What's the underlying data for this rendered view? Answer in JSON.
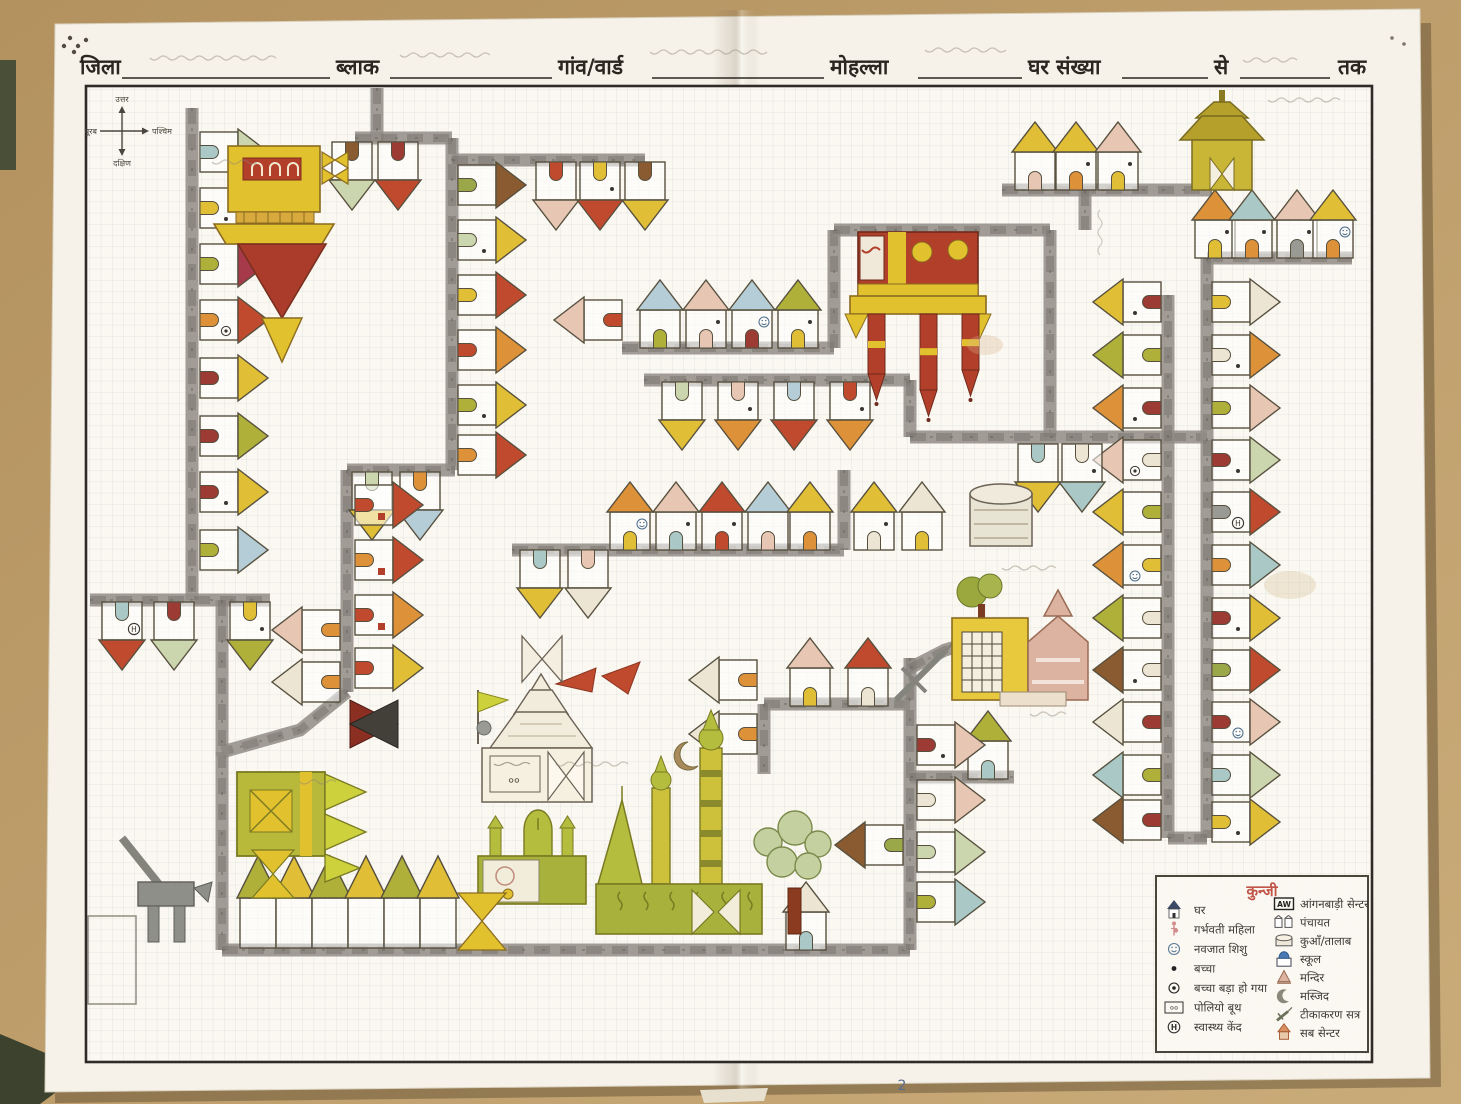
{
  "photo": {
    "desk_color": "#b3925f",
    "desk_color_light": "#c9ab79",
    "paper_color": "#f6f2e9"
  },
  "header": {
    "fields": [
      "जिला",
      "ब्लाक",
      "गांव/वार्ड",
      "मोहल्ला",
      "घर संख्या",
      "से",
      "तक"
    ]
  },
  "compass": {
    "north": "उत्तर",
    "south": "दक्षिण",
    "east": "पूरब",
    "west": "पश्चिम"
  },
  "legend": {
    "title": "कुन्जी",
    "left": [
      {
        "icon": "house-icon",
        "label": "घर"
      },
      {
        "icon": "pregnant-woman-icon",
        "label": "गर्भवती महिला"
      },
      {
        "icon": "newborn-icon",
        "label": "नवजात शिशु"
      },
      {
        "icon": "child-icon",
        "label": "बच्चा"
      },
      {
        "icon": "child-grown-icon",
        "label": "बच्चा बड़ा हो गया"
      },
      {
        "icon": "polio-booth-icon",
        "label": "पोलियो बूथ"
      },
      {
        "icon": "health-centre-icon",
        "label": "स्वास्थ्य केंद"
      }
    ],
    "right": [
      {
        "icon": "anganwadi-icon",
        "label": "आंगनबाड़ी सेन्टर",
        "badge": "AW"
      },
      {
        "icon": "panchayat-icon",
        "label": "पंचायत"
      },
      {
        "icon": "well-pond-icon",
        "label": "कुआँ/तालाब"
      },
      {
        "icon": "school-icon",
        "label": "स्कूल"
      },
      {
        "icon": "temple-icon",
        "label": "मन्दिर"
      },
      {
        "icon": "mosque-icon",
        "label": "मस्जिद"
      },
      {
        "icon": "vaccination-icon",
        "label": "टीकाकरण सत्र"
      },
      {
        "icon": "subcentre-icon",
        "label": "सब सेन्टर"
      }
    ],
    "polio_booth_glyph": "००",
    "health_glyph": "H"
  },
  "page_mark": "2",
  "map_data": {
    "type": "hand-drawn-village-map",
    "palette": {
      "yellow": "#e0bf36",
      "olive": "#aeb03a",
      "red": "#c04a2e",
      "darkred": "#9c3b33",
      "maroon": "#a63a4a",
      "orange": "#dd9138",
      "pink": "#e7c6b4",
      "lightgreen": "#ccd6ae",
      "teal": "#a9c8c6",
      "lightblue": "#b5cdd6",
      "brown": "#8a5a30",
      "pale": "#ece5d4",
      "green": "#9aa84a",
      "gray": "#9a9a94",
      "road": "#908c85",
      "roaddark": "#6f6a63"
    },
    "roads": [
      [
        [
          377,
          88
        ],
        [
          377,
          142
        ]
      ],
      [
        [
          355,
          138
        ],
        [
          452,
          138
        ]
      ],
      [
        [
          452,
          138
        ],
        [
          452,
          470
        ]
      ],
      [
        [
          452,
          160
        ],
        [
          645,
          160
        ]
      ],
      [
        [
          347,
          470
        ],
        [
          455,
          470
        ]
      ],
      [
        [
          347,
          470
        ],
        [
          347,
          692
        ]
      ],
      [
        [
          347,
          692
        ],
        [
          300,
          730
        ],
        [
          222,
          752
        ]
      ],
      [
        [
          222,
          752
        ],
        [
          222,
          950
        ]
      ],
      [
        [
          222,
          950
        ],
        [
          910,
          950
        ]
      ],
      [
        [
          192,
          108
        ],
        [
          192,
          600
        ]
      ],
      [
        [
          90,
          600
        ],
        [
          270,
          600
        ]
      ],
      [
        [
          222,
          600
        ],
        [
          222,
          756
        ]
      ],
      [
        [
          622,
          348
        ],
        [
          834,
          348
        ]
      ],
      [
        [
          834,
          230
        ],
        [
          834,
          348
        ]
      ],
      [
        [
          834,
          230
        ],
        [
          1050,
          230
        ]
      ],
      [
        [
          1050,
          230
        ],
        [
          1050,
          437
        ]
      ],
      [
        [
          644,
          380
        ],
        [
          910,
          380
        ]
      ],
      [
        [
          910,
          380
        ],
        [
          910,
          437
        ]
      ],
      [
        [
          910,
          437
        ],
        [
          1207,
          437
        ]
      ],
      [
        [
          512,
          550
        ],
        [
          844,
          550
        ]
      ],
      [
        [
          844,
          470
        ],
        [
          844,
          550
        ]
      ],
      [
        [
          1002,
          190
        ],
        [
          1212,
          190
        ]
      ],
      [
        [
          1085,
          190
        ],
        [
          1085,
          230
        ]
      ],
      [
        [
          1207,
          258
        ],
        [
          1352,
          258
        ]
      ],
      [
        [
          1207,
          258
        ],
        [
          1207,
          838
        ]
      ],
      [
        [
          1168,
          295
        ],
        [
          1168,
          838
        ]
      ],
      [
        [
          1168,
          838
        ],
        [
          1207,
          838
        ]
      ],
      [
        [
          764,
          704
        ],
        [
          910,
          704
        ]
      ],
      [
        [
          764,
          704
        ],
        [
          764,
          774
        ]
      ],
      [
        [
          910,
          658
        ],
        [
          910,
          950
        ]
      ],
      [
        [
          910,
          777
        ],
        [
          1014,
          777
        ]
      ],
      [
        [
          910,
          668
        ],
        [
          945,
          650
        ],
        [
          972,
          642
        ]
      ]
    ],
    "houses": [
      [
        200,
        152,
        "R",
        "lightgreen",
        "teal",
        ""
      ],
      [
        200,
        208,
        "R",
        "pink",
        "yellow",
        "dot"
      ],
      [
        200,
        264,
        "R",
        "maroon",
        "olive",
        ""
      ],
      [
        200,
        320,
        "R",
        "red",
        "orange",
        "circledot"
      ],
      [
        200,
        378,
        "R",
        "yellow",
        "darkred",
        ""
      ],
      [
        200,
        436,
        "R",
        "olive",
        "darkred",
        ""
      ],
      [
        200,
        492,
        "R",
        "yellow",
        "darkred",
        "dot"
      ],
      [
        200,
        550,
        "R",
        "lightblue",
        "olive",
        ""
      ],
      [
        458,
        185,
        "R",
        "brown",
        "green",
        ""
      ],
      [
        458,
        240,
        "R",
        "yellow",
        "lightgreen",
        "dot"
      ],
      [
        458,
        295,
        "R",
        "red",
        "yellow",
        ""
      ],
      [
        458,
        350,
        "R",
        "orange",
        "red",
        ""
      ],
      [
        458,
        405,
        "R",
        "yellow",
        "olive",
        "dot"
      ],
      [
        458,
        455,
        "R",
        "red",
        "orange",
        ""
      ],
      [
        352,
        142,
        "D",
        "lightgreen",
        "brown",
        ""
      ],
      [
        398,
        142,
        "D",
        "red",
        "darkred",
        ""
      ],
      [
        556,
        162,
        "D",
        "pink",
        "red",
        ""
      ],
      [
        600,
        162,
        "D",
        "red",
        "yellow",
        "dot"
      ],
      [
        645,
        162,
        "D",
        "yellow",
        "brown",
        ""
      ],
      [
        660,
        348,
        "U",
        "lightblue",
        "olive",
        ""
      ],
      [
        706,
        348,
        "U",
        "pink",
        "pink",
        "dot"
      ],
      [
        752,
        348,
        "U",
        "lightblue",
        "darkred",
        "smiley"
      ],
      [
        798,
        348,
        "U",
        "olive",
        "yellow",
        "dot"
      ],
      [
        622,
        320,
        "L",
        "pink",
        "red",
        ""
      ],
      [
        682,
        382,
        "D",
        "yellow",
        "lightgreen",
        ""
      ],
      [
        738,
        382,
        "D",
        "orange",
        "pink",
        "dot"
      ],
      [
        794,
        382,
        "D",
        "red",
        "lightblue",
        ""
      ],
      [
        850,
        382,
        "D",
        "orange",
        "red",
        "dot"
      ],
      [
        630,
        550,
        "U",
        "orange",
        "yellow",
        "smiley"
      ],
      [
        676,
        550,
        "U",
        "pink",
        "teal",
        "dot"
      ],
      [
        722,
        550,
        "U",
        "red",
        "red",
        "dot"
      ],
      [
        768,
        550,
        "U",
        "lightblue",
        "pink",
        ""
      ],
      [
        810,
        550,
        "U",
        "yellow",
        "orange",
        ""
      ],
      [
        874,
        550,
        "U",
        "yellow",
        "pale",
        "dot"
      ],
      [
        922,
        550,
        "U",
        "pale",
        "yellow",
        ""
      ],
      [
        540,
        550,
        "D",
        "yellow",
        "teal",
        ""
      ],
      [
        588,
        550,
        "D",
        "pale",
        "pink",
        ""
      ],
      [
        372,
        472,
        "D",
        "yellow",
        "lightgreen",
        ""
      ],
      [
        420,
        472,
        "D",
        "lightblue",
        "orange",
        ""
      ],
      [
        355,
        505,
        "R",
        "red",
        "red",
        "win"
      ],
      [
        355,
        560,
        "R",
        "red",
        "orange",
        "win"
      ],
      [
        355,
        615,
        "R",
        "orange",
        "red",
        "win"
      ],
      [
        355,
        668,
        "R",
        "yellow",
        "red",
        ""
      ],
      [
        340,
        630,
        "L",
        "pink",
        "orange",
        ""
      ],
      [
        340,
        682,
        "L",
        "pale",
        "orange",
        ""
      ],
      [
        122,
        602,
        "D",
        "red",
        "teal",
        "H"
      ],
      [
        174,
        602,
        "D",
        "lightgreen",
        "darkred",
        ""
      ],
      [
        250,
        602,
        "D",
        "olive",
        "yellow",
        "dot"
      ],
      [
        757,
        680,
        "L",
        "pale",
        "orange",
        ""
      ],
      [
        757,
        734,
        "L",
        "pale",
        "orange",
        ""
      ],
      [
        810,
        706,
        "U",
        "pink",
        "yellow",
        ""
      ],
      [
        868,
        706,
        "U",
        "red",
        "pale",
        ""
      ],
      [
        988,
        779,
        "U",
        "olive",
        "teal",
        ""
      ],
      [
        903,
        845,
        "L",
        "brown",
        "green",
        ""
      ],
      [
        917,
        745,
        "R",
        "pink",
        "darkred",
        "dot"
      ],
      [
        917,
        800,
        "R",
        "pink",
        "pale",
        ""
      ],
      [
        917,
        852,
        "R",
        "lightgreen",
        "lightgreen",
        ""
      ],
      [
        917,
        902,
        "R",
        "teal",
        "olive",
        ""
      ],
      [
        806,
        950,
        "U",
        "pale",
        "teal",
        ""
      ],
      [
        1161,
        302,
        "L",
        "yellow",
        "darkred",
        "dot"
      ],
      [
        1161,
        355,
        "L",
        "olive",
        "olive",
        ""
      ],
      [
        1161,
        408,
        "L",
        "orange",
        "darkred",
        "dot"
      ],
      [
        1161,
        460,
        "L",
        "pink",
        "pale",
        "circledot"
      ],
      [
        1161,
        512,
        "L",
        "yellow",
        "olive",
        ""
      ],
      [
        1161,
        565,
        "L",
        "orange",
        "yellow",
        "smiley"
      ],
      [
        1161,
        618,
        "L",
        "olive",
        "pale",
        ""
      ],
      [
        1161,
        670,
        "L",
        "brown",
        "pale",
        "dot"
      ],
      [
        1161,
        722,
        "L",
        "pale",
        "darkred",
        ""
      ],
      [
        1161,
        775,
        "L",
        "teal",
        "olive",
        ""
      ],
      [
        1161,
        820,
        "L",
        "brown",
        "darkred",
        ""
      ],
      [
        1212,
        302,
        "R",
        "pale",
        "yellow",
        ""
      ],
      [
        1212,
        355,
        "R",
        "orange",
        "pale",
        "dot"
      ],
      [
        1212,
        408,
        "R",
        "pink",
        "olive",
        ""
      ],
      [
        1212,
        460,
        "R",
        "lightgreen",
        "darkred",
        "dot"
      ],
      [
        1212,
        512,
        "R",
        "red",
        "gray",
        "H"
      ],
      [
        1212,
        565,
        "R",
        "teal",
        "orange",
        ""
      ],
      [
        1212,
        618,
        "R",
        "yellow",
        "darkred",
        "dot"
      ],
      [
        1212,
        670,
        "R",
        "red",
        "green",
        ""
      ],
      [
        1212,
        722,
        "R",
        "pink",
        "darkred",
        "smiley"
      ],
      [
        1212,
        775,
        "R",
        "lightgreen",
        "teal",
        ""
      ],
      [
        1212,
        822,
        "R",
        "yellow",
        "yellow",
        "dot"
      ],
      [
        1215,
        258,
        "U",
        "orange",
        "yellow",
        "dot"
      ],
      [
        1252,
        258,
        "U",
        "teal",
        "orange",
        "dot"
      ],
      [
        1297,
        258,
        "U",
        "pink",
        "gray",
        "dot"
      ],
      [
        1333,
        258,
        "U",
        "yellow",
        "orange",
        "smiley"
      ],
      [
        1035,
        190,
        "U",
        "yellow",
        "pink",
        ""
      ],
      [
        1076,
        190,
        "U",
        "yellow",
        "orange",
        "dot"
      ],
      [
        1118,
        190,
        "U",
        "pink",
        "yellow",
        "dot"
      ],
      [
        1038,
        444,
        "D",
        "yellow",
        "teal",
        ""
      ],
      [
        1082,
        444,
        "D",
        "teal",
        "pale",
        "dot"
      ]
    ],
    "tents": {
      "y": 948,
      "items": [
        [
          258,
          "olive"
        ],
        [
          294,
          "yellow"
        ],
        [
          330,
          "olive"
        ],
        [
          366,
          "yellow"
        ],
        [
          402,
          "olive"
        ],
        [
          438,
          "yellow"
        ]
      ]
    },
    "landmarks": [
      {
        "id": "big-yellow-building",
        "x": 228,
        "y": 140
      },
      {
        "id": "red-yellow-building",
        "x": 852,
        "y": 228
      },
      {
        "id": "pagoda-building",
        "x": 1175,
        "y": 88
      },
      {
        "id": "school-building",
        "x": 948,
        "y": 578
      },
      {
        "id": "polio-booth-temple",
        "x": 468,
        "y": 664
      },
      {
        "id": "green-building",
        "x": 235,
        "y": 768
      },
      {
        "id": "small-mosque",
        "x": 475,
        "y": 805
      },
      {
        "id": "large-mosque",
        "x": 592,
        "y": 712
      },
      {
        "id": "large-tree",
        "x": 758,
        "y": 815
      },
      {
        "id": "hand-pump",
        "x": 104,
        "y": 828
      },
      {
        "id": "well-pond",
        "x": 968,
        "y": 480
      },
      {
        "id": "dark-bowtie",
        "x": 350,
        "y": 698
      },
      {
        "id": "white-bowtie",
        "x": 522,
        "y": 636
      },
      {
        "id": "yellow-bowtie",
        "x": 458,
        "y": 893
      },
      {
        "id": "empty-plot",
        "x": 86,
        "y": 914
      }
    ],
    "handwriting_notes": [
      {
        "x": 150,
        "y": 58,
        "n": 14,
        "where": "header-district"
      },
      {
        "x": 400,
        "y": 55,
        "n": 10,
        "where": "header-block"
      },
      {
        "x": 650,
        "y": 52,
        "n": 13,
        "where": "header-village"
      },
      {
        "x": 925,
        "y": 50,
        "n": 9,
        "where": "header-mohalla"
      },
      {
        "x": 1243,
        "y": 60,
        "n": 6,
        "where": "header-se"
      },
      {
        "x": 1268,
        "y": 100,
        "n": 8,
        "where": "near-pagoda"
      },
      {
        "x": 212,
        "y": 162,
        "n": 5,
        "where": "near-yellow-building"
      },
      {
        "x": 556,
        "y": 764,
        "n": 8,
        "where": "near-mosque"
      },
      {
        "x": 1002,
        "y": 568,
        "n": 6,
        "where": "near-well"
      },
      {
        "x": 300,
        "y": 782,
        "n": 4,
        "where": "near-green-building"
      },
      {
        "x": 1030,
        "y": 714,
        "n": 4,
        "where": "near-school"
      }
    ]
  }
}
